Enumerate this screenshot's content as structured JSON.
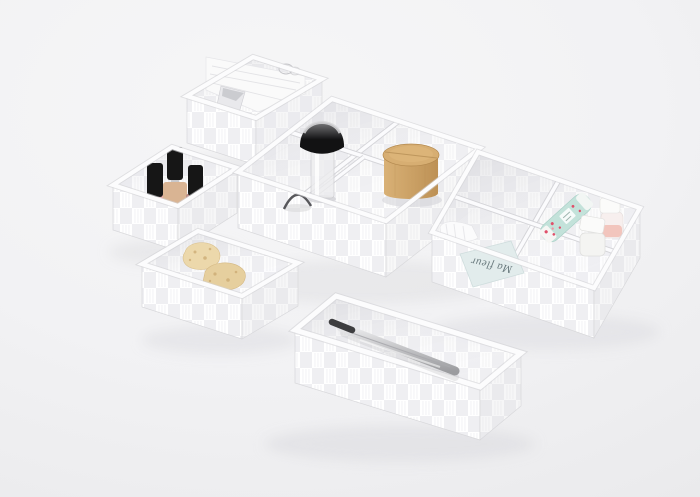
{
  "scene": {
    "type": "product-photo",
    "description": "Set of white woven-nylon storage organizer baskets holding bathroom and cosmetic accessories, photographed on a light grey studio background",
    "items": [
      "tall woven basket with folded cotton towels, foil sachet and embossed logo",
      "small square woven basket with three black-capped nail polish bottles",
      "multi-compartment woven organizer tray",
      "kabuki makeup brush with clear acrylic handle",
      "round bamboo canister with lid",
      "compartment with round mirror edge",
      "woven organizer with mint floral cosmetic tube and two travel bottles",
      "printed card reading Ma fleur",
      "woven basket with two natural sea sponges",
      "long woven box with steel tweezers resting on its rim"
    ]
  },
  "card": {
    "text": "Ma fleur"
  },
  "colors": {
    "shadow": "#d9d9dd",
    "towel": "#fafafa",
    "sachet_foil": "#c6c7cb",
    "polish_cap": "#161616",
    "polish_nude": "#d9b493",
    "polish_pink": "#e8aca6",
    "polish_dark": "#bb8d87",
    "bristle_top": "#7a7a7c",
    "bristle": "#121213",
    "handle": "#ececee",
    "ferrule": "#d4d4d7",
    "bamboo_light": "#d9b176",
    "bamboo_dark": "#bd9155",
    "bamboo_lid": "#d7ae72",
    "mirror_arc": "#46464a",
    "sponge_a": "#ecd8ab",
    "sponge_b": "#e6cf9e",
    "sponge_dot": "#c9a76e",
    "tube_mint": "#c3e2da",
    "floral_pink": "#e0506a",
    "floral_light": "#f096a5",
    "bottle_white": "#f4f4f2",
    "bottle_pink": "#f2c5bd",
    "cap_white": "#fbfbfa",
    "card_bg": "#e2ecec",
    "card_text_color": "#6a7a7e",
    "steel_light": "#ebebed",
    "steel_dark": "#9b9c9f",
    "tweezer_tip": "#3e3e40",
    "cotton": "#fbfbfc"
  }
}
